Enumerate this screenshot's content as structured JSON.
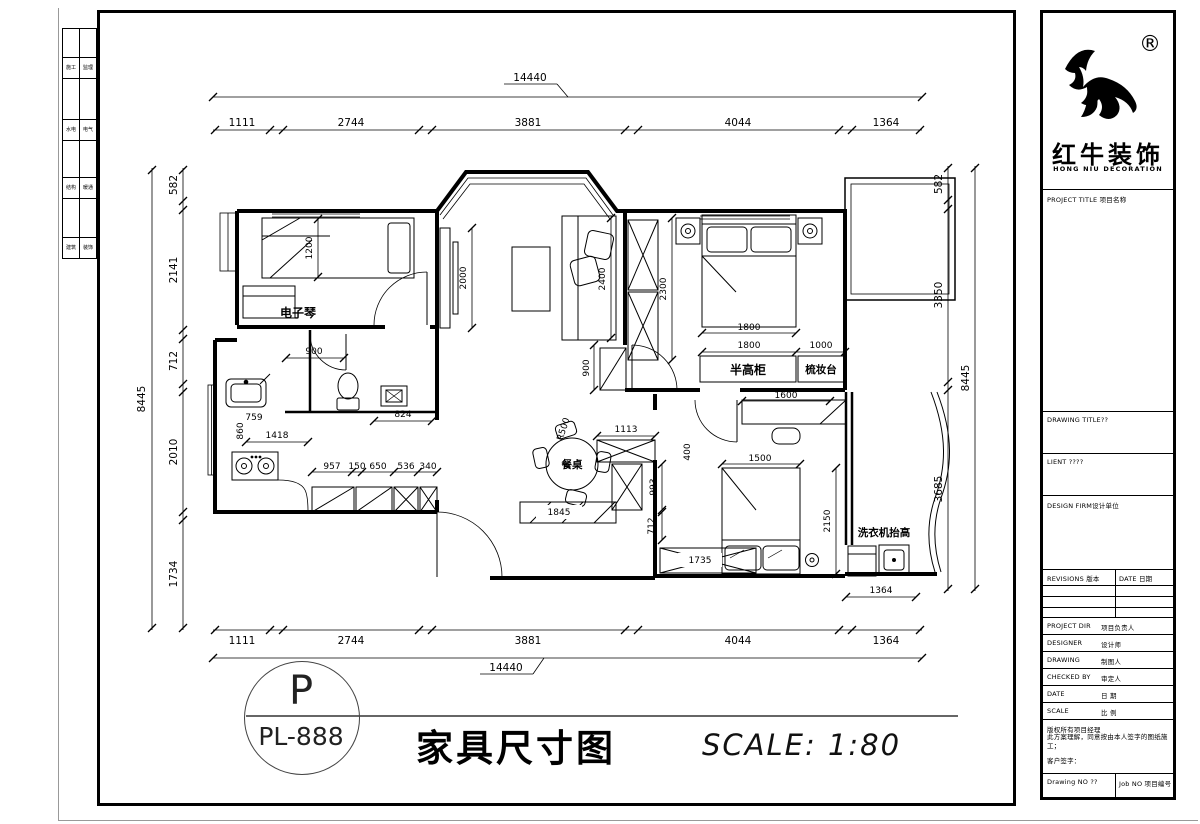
{
  "logo": {
    "cn": "红牛装饰",
    "en": "HONG NIU DECORATION",
    "reg": "®"
  },
  "title_block": {
    "project_title": "PROJECT TITLE 项目名称",
    "drawing_title": "DRAWING TITLE??",
    "client": "LIENT ????",
    "design_firm": "DESIGN FIRM设计单位",
    "revisions": "REVISIONS 版本",
    "date_col": "DATE 日期",
    "rows": [
      {
        "en": "PROJECT DIR",
        "cn": "项目负责人"
      },
      {
        "en": "DESIGNER",
        "cn": "设计师"
      },
      {
        "en": "DRAWING",
        "cn": "制图人"
      },
      {
        "en": "CHECKED BY",
        "cn": "审定人"
      },
      {
        "en": "DATE",
        "cn": "日 期"
      },
      {
        "en": "SCALE",
        "cn": "比 例"
      }
    ],
    "copyright1": "版权所有项目经理",
    "copyright2": "此方案理解，同意按由本人签字的图纸施工；",
    "signature": "客户签字：",
    "drawing_no": "Drawing NO ??",
    "job_no": "Job NO 项目编号"
  },
  "side_strip": [
    "施工",
    "监理",
    "水电",
    "电气",
    "结构",
    "暖通",
    "建筑",
    "装饰"
  ],
  "footer": {
    "circle_letter": "P",
    "circle_code": "PL-888",
    "title": "家具尺寸图",
    "scale": "SCALE: 1:80"
  },
  "plan": {
    "labels": {
      "piano": "电子琴",
      "dining_table": "餐桌",
      "half_cabinet": "半高柜",
      "dresser": "梳妆台",
      "washer": "洗衣机抬高"
    },
    "dims": {
      "h_chain": [
        "1111",
        "2744",
        "3881",
        "4044",
        "1364"
      ],
      "h_total": "14440",
      "left_chain": [
        "582",
        "2141",
        "712",
        "2010",
        "1734"
      ],
      "right_chain": [
        "582",
        "3350",
        "3685"
      ],
      "v_total": "8445",
      "bed1_w": "1200",
      "tv_len": "2000",
      "sofa_len": "2400",
      "wardrobe": "2300",
      "bed2_w": "1800",
      "cab_w": "1800",
      "dresser_w": "1000",
      "hall_door": "900",
      "bath_door": "900",
      "radius": "R500",
      "d1113": "1113",
      "d400": "400",
      "d993": "993",
      "d712": "712",
      "shoe_cab": "1845",
      "cab1735": "1735",
      "bed3_w": "1500",
      "bed3_l": "2150",
      "desk": "1600",
      "washer_niche": "1364",
      "k759": "759",
      "k860": "860",
      "k1418": "1418",
      "k957": "957",
      "k150": "150",
      "k650": "650",
      "k536": "536",
      "k340": "340",
      "shower": "824"
    }
  }
}
